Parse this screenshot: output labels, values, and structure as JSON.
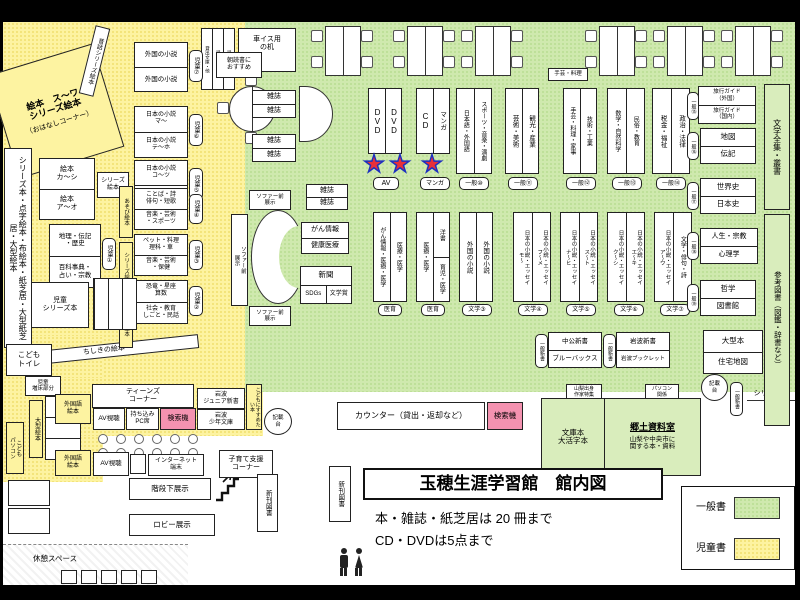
{
  "page": {
    "title": "玉穂生涯学習館　館内図",
    "rule1": "本・雑誌・紙芝居は 20 冊まで",
    "rule2": "CD・DVDは5点まで"
  },
  "legend": {
    "general": "一般書",
    "children": "児童書"
  },
  "colors": {
    "general_green": "#cfe9ae",
    "children_yellow": "#fdf3a1",
    "search_pink": "#f492b0"
  },
  "labels": {
    "ehon_suwa": "絵本　ス〜ワ\nシリーズ絵本",
    "ohanashi": "（おはなしコーナー）",
    "mukashi": "昔話シリーズ絵本",
    "chishiki": "ちしきの絵本",
    "tenji_wall": "シリーズ本・点字絵本・布絵本・紙芝居・大型紙芝居・大型絵本",
    "ehon_kashi": "絵本\nカ〜シ",
    "ehon_ao": "絵本\nア〜オ",
    "series_ehon2": "シリーズ\n絵本",
    "series_ehon_v": "シリーズ絵本",
    "asobi_ehon": "あそび絵本",
    "jido_ogata_v": "児童大型本",
    "chiri": "地理・伝記\n・歴史",
    "hyakka": "百科事典・\n占い・宗教",
    "kotoba": "ことば・詩\n俳句・短歌",
    "ongaku_sports": "音楽・芸術\n・スポーツ",
    "pet": "ペット・料理\n理科・車",
    "ongaku_hoken": "音楽・芸術\n・保健",
    "kyoryu": "恐竜・星座\n算数",
    "shakai": "社会・教育\nしごと・民話",
    "jido1": "児童①",
    "jido2": "児童②",
    "jido3": "児童③",
    "jido4": "児童④",
    "jido5": "児童⑤",
    "jido6": "児童⑥",
    "jido7": "児童⑦",
    "jido_series": "児童\nシリーズ本",
    "kodomo_toilet": "こども\nトイレ",
    "jido_zosho": "児童\n増床部分",
    "ogata_ehon": "大型絵本",
    "kodomo_pc": "こども\nパソコン",
    "gaikoku_shosetsu": "外国の小説",
    "nihon_ma": "日本の小説\nマ〜",
    "nihon_teho": "日本の小説\nテ〜ホ",
    "nihon_kotsu": "日本の小説\nコ〜ツ",
    "nihon_ake": "日本の小説\nア〜ケ",
    "jido_bunko": "児童文庫",
    "jido_shinsho": "児童新書",
    "kashidashi": "貸出文庫・他",
    "asadoku": "朝読書に\nおすすめ",
    "kurumaisu": "車イス用\nの机",
    "wheelchair_icon": "♿",
    "zasshi": "雑誌",
    "sofa_tenji": "ソファー前\n展示",
    "gan_joho": "がん情報",
    "kenko_iryo": "健康医療",
    "shinbun": "新聞",
    "sdgs": "SDGs",
    "bungakusho": "文学賞",
    "shugei_ryori_s": "手芸・料理",
    "dvd": "DVD",
    "cd": "CD",
    "manga": "マンガ",
    "tag_av": "AV",
    "tag_manga": "マンガ",
    "nihongo": "日本語・外国語",
    "sports_ongaku": "スポーツ・音楽・演劇",
    "geijutsu": "芸術・美術",
    "kanko": "観光・産業",
    "shugei_kaji": "手芸・料理・家事",
    "gijutsu": "技術・工業",
    "sugaku": "数学・自然科学",
    "minzoku": "民俗・教育",
    "zeikin": "税金・福祉",
    "seiji": "政治・法律",
    "ippan10": "一般⑩",
    "ippan11": "一般⑪",
    "ippan12": "一般⑫",
    "ippan13": "一般⑬",
    "ippan14": "一般⑭",
    "ippan15": "一般⑮",
    "ippan16": "一般⑯",
    "ippan17": "一般⑰",
    "ippan18": "一般⑱",
    "ippan19": "一般⑲",
    "gan_iryo": "がん情報・医療・医学",
    "iryo_igaku": "医療・医学",
    "yosho": "洋書",
    "ikuji": "育児・医学",
    "tag_iiku": "医育",
    "essay_mo": "日本の小説・エッセイ\nモ〜",
    "essay_fume": "日本の小説・エッセイ\nフ〜メ",
    "essay_nahi": "日本の小説・エッセイ\nナ〜ヒ",
    "essay_suto": "日本の小説・エッセイ\nス〜ト",
    "essay_kushi": "日本の小説・エッセイ\nク〜シ",
    "essay_eki": "日本の小説・エッセイ\nエ〜キ",
    "essay_au": "日本の小説・エッセイ\nア〜ウ",
    "bungaku_haiku": "文学・俳句・詩",
    "bungaku3": "文学③",
    "bungaku4": "文学④",
    "bungaku5": "文学⑤",
    "bungaku6": "文学⑥",
    "bungaku7": "文学⑦",
    "ryoko_gaikoku": "旅行ガイド\n（外国）",
    "ryoko_kokunai": "旅行ガイド\n（国内）",
    "chizu": "地図",
    "denki": "伝記",
    "sekaishi": "世界史",
    "nihonshi": "日本史",
    "jinsei": "人生・宗教",
    "shinri": "心理学",
    "tetsugaku": "哲学",
    "toshokan": "図書館",
    "ogata_bon": "大型本",
    "jutaku": "住宅地図",
    "bungaku_zenshu": "文学全集・叢書",
    "sanko": "参考図書（図鑑・辞書など）",
    "chuko": "中公新書",
    "bluebacks": "ブルーバックス",
    "iwanami_shinsho": "岩波新書",
    "iwanami_booklet": "岩波ブックレット",
    "ippan_shinsho": "一般新書",
    "yamanashi_sakka": "山梨出身\n作家特集",
    "pc_kankei": "パソコン\n関係",
    "kisaidai": "記載\n台",
    "series_bon": "シリーズ本",
    "counter": "カウンター（貸出・返却など）",
    "kensakuki": "検索機",
    "bunkobon": "文庫本\n大活字本",
    "kyodo_title": "郷土資料室",
    "kyodo_desc": "山梨や中央市に\n関する本・資料",
    "teens": "ティーンズ\nコーナー",
    "av_shicho": "AV視聴",
    "mochikomi": "持ち込み\nPC席",
    "iwanami_jr": "岩波\nジュニア新書",
    "iwanami_shonen": "岩波\n少年文庫",
    "kodomo_susume": "こどもにすすめたい本",
    "gaikokugo_ehon": "外国語\n絵本",
    "internet": "インターネット\n端末",
    "kosodate": "子育て支援\nコーナー",
    "kaidan": "階段下展示",
    "lobby": "ロビー展示",
    "kyukei": "休憩スペース",
    "shinkan": "新刊図書"
  }
}
